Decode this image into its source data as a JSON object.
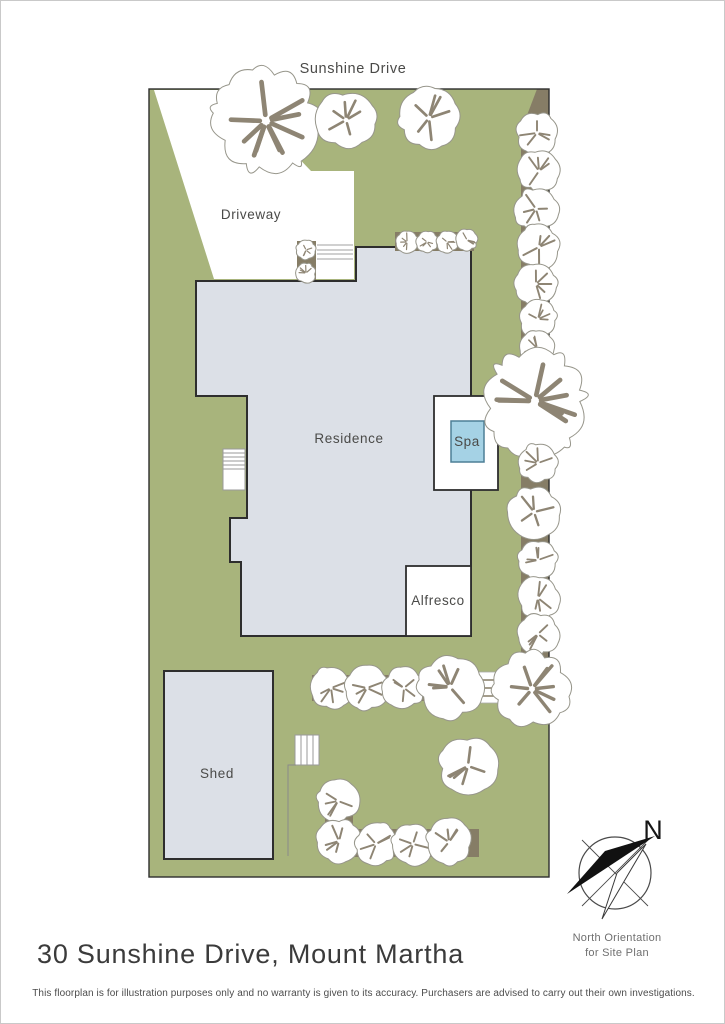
{
  "page": {
    "title": "30 Sunshine Drive, Mount Martha",
    "disclaimer": "This floorplan is for illustration purposes only and no warranty is given to its accuracy. Purchasers are advised to carry out their own investigations."
  },
  "plan": {
    "street_label": "Sunshine Drive",
    "driveway_label": "Driveway",
    "residence_label": "Residence",
    "spa_label": "Spa",
    "alfresco_label": "Alfresco",
    "shed_label": "Shed"
  },
  "compass": {
    "north_letter": "N",
    "caption_line1": "North Orientation",
    "caption_line2": "for Site Plan"
  },
  "colors": {
    "grass": "#a8b47c",
    "garden-bed": "#867d66",
    "building-fill": "#dce0e7",
    "building-outline": "#2e2e2e",
    "spa-fill": "#a5d2e5",
    "spa-border": "#4d7f96",
    "tree-stroke": "#97968b",
    "tree-slash": "#8e8574",
    "label-text": "#4a4a48"
  }
}
